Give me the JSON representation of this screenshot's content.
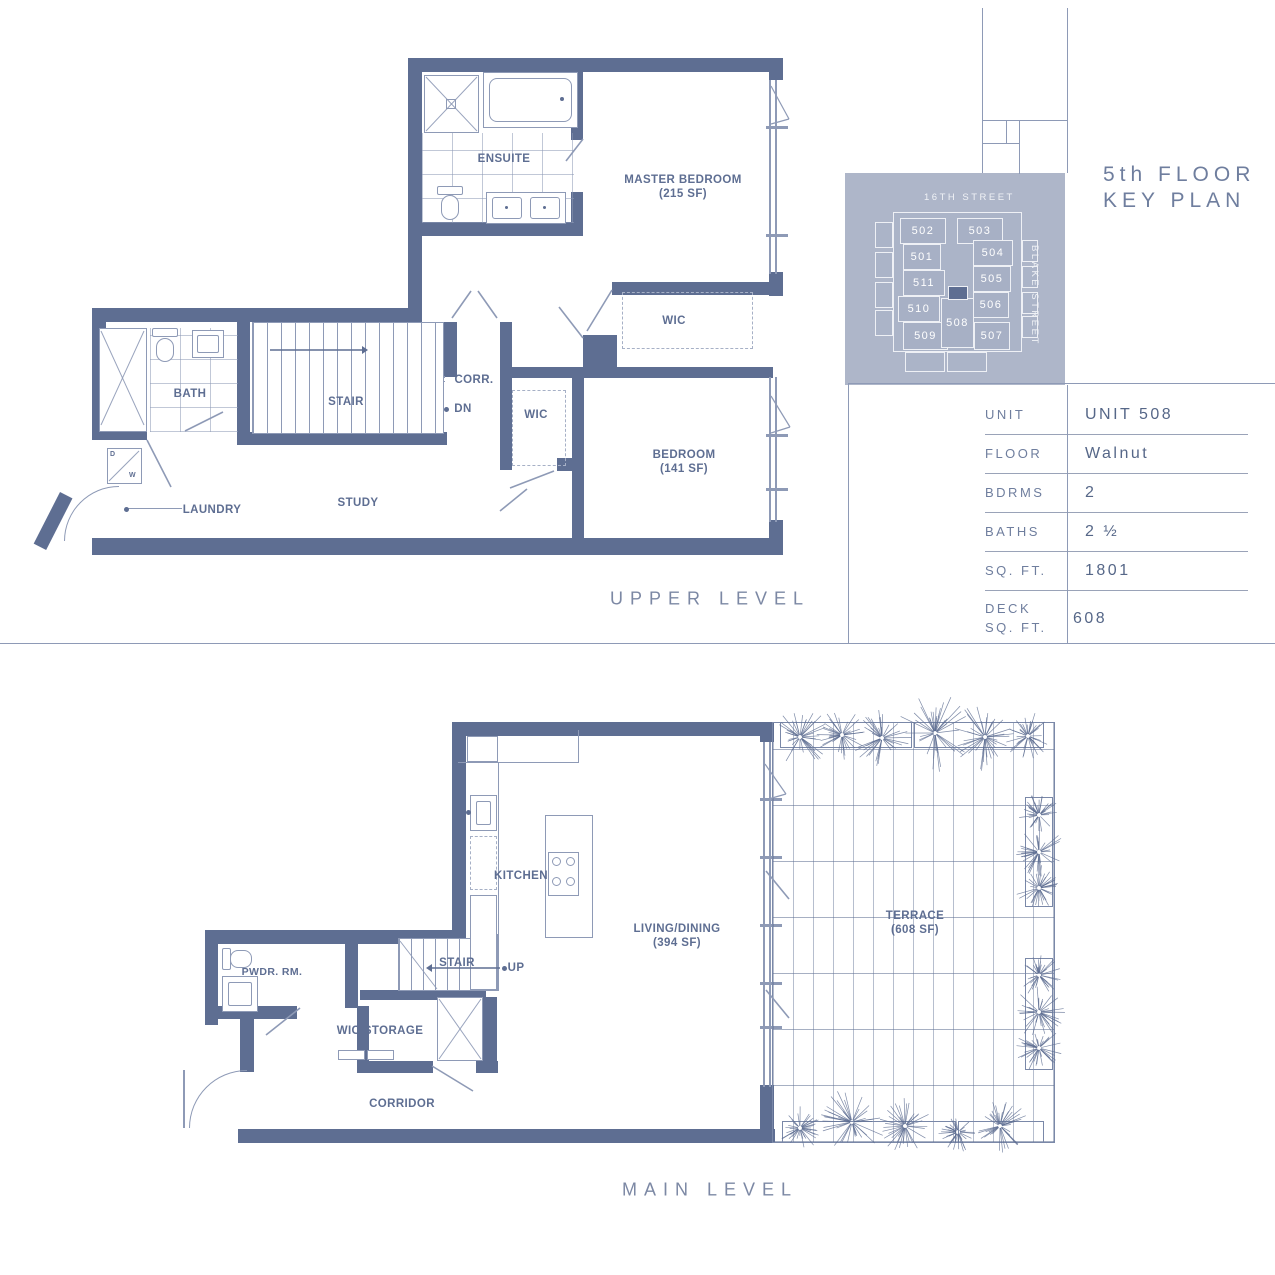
{
  "palette": {
    "wall": "#5e6e92",
    "thin_line": "#8e9ab6",
    "keyplan_bg": "#aeb6c9",
    "keyplan_cell": "#a7b0c5",
    "keyplan_highlight": "#5e6e92",
    "panel_text": "#6f7e9e",
    "value_text": "#566788"
  },
  "upper": {
    "title": "UPPER LEVEL",
    "ensuite": "ENSUITE",
    "master": "MASTER BEDROOM",
    "master_area": "(215 SF)",
    "wic1": "WIC",
    "corr": "CORR.",
    "stair": "STAIR",
    "dn": "DN",
    "bath": "BATH",
    "wic2": "WIC",
    "bedroom": "BEDROOM",
    "bedroom_area": "(141 SF)",
    "laundry": "LAUNDRY",
    "study": "STUDY",
    "dryer": "D",
    "washer": "W"
  },
  "main": {
    "title": "MAIN LEVEL",
    "kitchen": "KITCHEN",
    "living": "LIVING/DINING",
    "living_area": "(394 SF)",
    "terrace": "TERRACE",
    "terrace_area": "(608 SF)",
    "stair": "STAIR",
    "up": "UP",
    "pwdr": "PWDR. RM.",
    "wic_storage": "WIC/STORAGE",
    "corridor": "CORRIDOR"
  },
  "key_plan": {
    "title1": "5th FLOOR",
    "title2": "KEY PLAN",
    "street_top": "16TH STREET",
    "street_right": "BLAKE STREET",
    "units": [
      "502",
      "503",
      "501",
      "504",
      "511",
      "505",
      "510",
      "506",
      "509",
      "508",
      "507"
    ],
    "highlighted": "508"
  },
  "table": {
    "rows": [
      {
        "label": "UNIT",
        "value": "UNIT 508"
      },
      {
        "label": "FLOOR",
        "value": "Walnut"
      },
      {
        "label": "BDRMS",
        "value": "2"
      },
      {
        "label": "BATHS",
        "value": "2 ½"
      },
      {
        "label": "SQ. FT.",
        "value": "1801"
      },
      {
        "label": "DECK SQ. FT.",
        "value": "608"
      }
    ]
  }
}
